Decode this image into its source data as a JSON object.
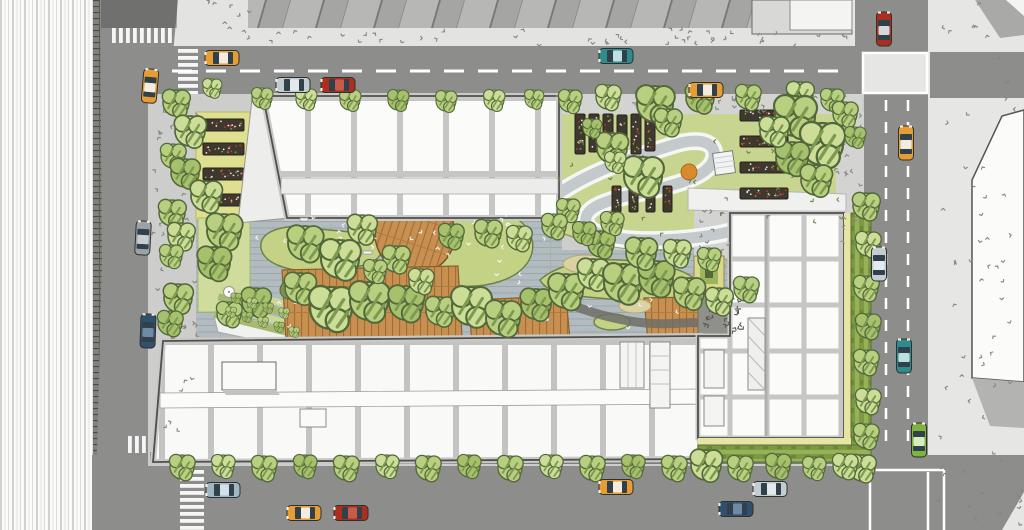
{
  "meta": {
    "title": "Aerial site plan illustration - urban block with landscaped green courtyard",
    "description": "Top-down architectural rendering: three white flat-roofed buildings around a central courtyard garden with trees, wood decks, lawns, an S-shaped path, raised planting beds, surrounded by streets with cars, crosswalks and sidewalks."
  },
  "palette": {
    "road": "#8d8d8b",
    "road_shadow": "#767674",
    "lane_white": "#ffffff",
    "sidewalk_site": "#cdcdcb",
    "sidewalk_far": "#e6e6e4",
    "sidewalk_light": "#e3e3e1",
    "building_white": "#fbfbf9",
    "mullion_gray": "#c6c6c4",
    "outline": "#4f4f4d",
    "deck_gray": "#b2bcc0",
    "wood": "#c79050",
    "lawn": "#c3d285",
    "lawn_light": "#cfdc9b",
    "garden": "#c8d590",
    "yellow_band": "#dfdf90",
    "planter_dark": "#3e382e",
    "hedge": "#7d9a43",
    "tree": "#b9cf80",
    "tree_light": "#cbdd96",
    "tree_dark": "#a6c06c",
    "sand": "#dbd2a3",
    "gravel": "#90908a",
    "path_gray": "#c4cacc",
    "car_red": "#ab2f1f",
    "car_teal": "#2f8c8c",
    "car_taxi": "#e79d33",
    "car_silver": "#c2cdd1",
    "car_navy": "#31506b",
    "car_green": "#7eb33d",
    "car_gray": "#9aa2a5"
  },
  "scene": {
    "trees": [
      [
        176,
        103,
        13,
        0
      ],
      [
        190,
        131,
        15,
        1
      ],
      [
        173,
        156,
        12,
        0
      ],
      [
        185,
        173,
        14,
        2
      ],
      [
        172,
        213,
        13,
        0
      ],
      [
        181,
        236,
        13,
        1
      ],
      [
        171,
        256,
        11,
        0
      ],
      [
        178,
        298,
        14,
        0
      ],
      [
        170,
        323,
        12,
        2
      ],
      [
        206,
        196,
        15,
        1
      ],
      [
        224,
        231,
        17,
        0
      ],
      [
        214,
        263,
        16,
        2
      ],
      [
        212,
        88,
        9,
        1
      ],
      [
        262,
        98,
        10,
        0
      ],
      [
        306,
        99,
        10,
        1
      ],
      [
        350,
        100,
        10,
        0
      ],
      [
        398,
        100,
        10,
        2
      ],
      [
        446,
        101,
        10,
        0
      ],
      [
        494,
        100,
        10,
        1
      ],
      [
        534,
        99,
        9,
        0
      ],
      [
        570,
        101,
        11,
        0
      ],
      [
        608,
        97,
        12,
        1
      ],
      [
        655,
        104,
        18,
        0
      ],
      [
        700,
        98,
        14,
        2
      ],
      [
        748,
        97,
        12,
        0
      ],
      [
        800,
        95,
        13,
        1
      ],
      [
        832,
        100,
        11,
        0
      ],
      [
        612,
        148,
        15,
        0
      ],
      [
        643,
        176,
        19,
        1
      ],
      [
        668,
        122,
        13,
        0
      ],
      [
        592,
        128,
        9,
        2
      ],
      [
        568,
        210,
        11,
        0
      ],
      [
        615,
        162,
        10,
        1
      ],
      [
        795,
        116,
        20,
        0
      ],
      [
        822,
        144,
        21,
        1
      ],
      [
        792,
        158,
        16,
        2
      ],
      [
        816,
        180,
        15,
        0
      ],
      [
        774,
        131,
        14,
        1
      ],
      [
        845,
        114,
        12,
        0
      ],
      [
        855,
        137,
        10,
        2
      ],
      [
        305,
        243,
        17,
        0
      ],
      [
        340,
        259,
        19,
        1
      ],
      [
        300,
        288,
        15,
        0
      ],
      [
        256,
        302,
        14,
        2
      ],
      [
        229,
        314,
        12,
        0
      ],
      [
        331,
        308,
        21,
        1
      ],
      [
        369,
        301,
        19,
        0
      ],
      [
        406,
        303,
        17,
        2
      ],
      [
        440,
        311,
        14,
        0
      ],
      [
        471,
        306,
        19,
        1
      ],
      [
        503,
        318,
        17,
        0
      ],
      [
        536,
        304,
        15,
        2
      ],
      [
        566,
        291,
        17,
        0
      ],
      [
        593,
        274,
        15,
        1
      ],
      [
        623,
        283,
        19,
        0
      ],
      [
        656,
        278,
        17,
        2
      ],
      [
        689,
        293,
        15,
        0
      ],
      [
        719,
        301,
        13,
        1
      ],
      [
        746,
        289,
        12,
        0
      ],
      [
        601,
        244,
        13,
        2
      ],
      [
        641,
        253,
        15,
        0
      ],
      [
        677,
        253,
        13,
        1
      ],
      [
        709,
        259,
        11,
        0
      ],
      [
        362,
        229,
        14,
        1
      ],
      [
        396,
        259,
        13,
        0
      ],
      [
        451,
        236,
        12,
        2
      ],
      [
        488,
        233,
        13,
        0
      ],
      [
        519,
        238,
        12,
        1
      ],
      [
        554,
        226,
        12,
        0
      ],
      [
        584,
        233,
        11,
        2
      ],
      [
        612,
        223,
        11,
        0
      ],
      [
        421,
        281,
        12,
        1
      ],
      [
        375,
        271,
        11,
        0
      ],
      [
        866,
        206,
        13,
        0
      ],
      [
        868,
        244,
        12,
        1
      ],
      [
        866,
        288,
        12,
        0
      ],
      [
        868,
        326,
        12,
        2
      ],
      [
        866,
        362,
        12,
        0
      ],
      [
        868,
        401,
        12,
        1
      ],
      [
        866,
        436,
        12,
        0
      ],
      [
        862,
        468,
        13,
        1
      ],
      [
        182,
        467,
        12,
        0
      ],
      [
        223,
        466,
        11,
        1
      ],
      [
        264,
        468,
        12,
        0
      ],
      [
        305,
        466,
        11,
        2
      ],
      [
        346,
        468,
        12,
        0
      ],
      [
        387,
        466,
        11,
        1
      ],
      [
        428,
        468,
        12,
        0
      ],
      [
        469,
        466,
        11,
        2
      ],
      [
        510,
        468,
        12,
        0
      ],
      [
        551,
        466,
        11,
        1
      ],
      [
        592,
        468,
        12,
        0
      ],
      [
        633,
        466,
        11,
        2
      ],
      [
        674,
        468,
        12,
        0
      ],
      [
        706,
        465,
        15,
        1
      ],
      [
        740,
        468,
        12,
        0
      ],
      [
        778,
        466,
        12,
        2
      ],
      [
        814,
        468,
        11,
        0
      ],
      [
        845,
        466,
        12,
        1
      ],
      [
        236,
        298,
        5,
        2
      ],
      [
        252,
        303,
        5,
        0
      ],
      [
        268,
        308,
        5,
        2
      ],
      [
        284,
        313,
        5,
        0
      ],
      [
        231,
        312,
        5,
        0
      ],
      [
        247,
        317,
        5,
        2
      ],
      [
        263,
        322,
        5,
        0
      ],
      [
        279,
        327,
        5,
        2
      ],
      [
        294,
        332,
        5,
        0
      ]
    ],
    "cars": [
      {
        "x": 222,
        "y": 58,
        "rot": 0,
        "body": "#e79d33",
        "roof": "#f2ede0"
      },
      {
        "x": 293,
        "y": 85,
        "rot": 0,
        "body": "#c2cdd1",
        "roof": "#e4eaec"
      },
      {
        "x": 338,
        "y": 85,
        "rot": 0,
        "body": "#ab2f1f",
        "roof": "#c65b4a"
      },
      {
        "x": 616,
        "y": 56,
        "rot": 0,
        "body": "#2f8c8c",
        "roof": "#bfe0e0"
      },
      {
        "x": 706,
        "y": 90,
        "rot": 0,
        "body": "#e79d33",
        "roof": "#f2ede0"
      },
      {
        "x": 884,
        "y": 29,
        "rot": 90,
        "body": "#ab2f1f",
        "roof": "#d5d8d8"
      },
      {
        "x": 906,
        "y": 143,
        "rot": 90,
        "body": "#e79d33",
        "roof": "#f2ede0"
      },
      {
        "x": 879,
        "y": 264,
        "rot": 90,
        "body": "#c2cdd1",
        "roof": "#e4eaec"
      },
      {
        "x": 904,
        "y": 356,
        "rot": 90,
        "body": "#2f8c8c",
        "roof": "#bfe0e0"
      },
      {
        "x": 919,
        "y": 440,
        "rot": 90,
        "body": "#7eb33d",
        "roof": "#d9ecc0"
      },
      {
        "x": 150,
        "y": 86,
        "rot": 95,
        "body": "#e79d33",
        "roof": "#f2ede0"
      },
      {
        "x": 143,
        "y": 238,
        "rot": 93,
        "body": "#9aa2a5",
        "roof": "#c8cfd2"
      },
      {
        "x": 148,
        "y": 331,
        "rot": 92,
        "body": "#31506b",
        "roof": "#6e8aa5"
      },
      {
        "x": 223,
        "y": 490,
        "rot": 0,
        "body": "#9fb6c4",
        "roof": "#d3e2ea"
      },
      {
        "x": 304,
        "y": 513,
        "rot": 0,
        "body": "#e79d33",
        "roof": "#f2ede0"
      },
      {
        "x": 351,
        "y": 513,
        "rot": 0,
        "body": "#ab2f1f",
        "roof": "#c65b4a"
      },
      {
        "x": 616,
        "y": 487,
        "rot": 0,
        "body": "#e79d33",
        "roof": "#f2ede0"
      },
      {
        "x": 770,
        "y": 489,
        "rot": 0,
        "body": "#c2cdd1",
        "roof": "#e4eaec"
      },
      {
        "x": 736,
        "y": 509,
        "rot": 0,
        "body": "#31506b",
        "roof": "#6e8aa5"
      }
    ],
    "garden_beds": [
      [
        575,
        114,
        10,
        40
      ],
      [
        589,
        114,
        10,
        38
      ],
      [
        603,
        114,
        10,
        40
      ],
      [
        617,
        115,
        10,
        38
      ],
      [
        631,
        114,
        10,
        40
      ],
      [
        645,
        115,
        10,
        36
      ],
      [
        612,
        186,
        9,
        26
      ],
      [
        629,
        186,
        9,
        26
      ],
      [
        646,
        187,
        9,
        25
      ],
      [
        663,
        186,
        9,
        26
      ],
      [
        740,
        110,
        48,
        11
      ],
      [
        740,
        136,
        48,
        11
      ],
      [
        740,
        162,
        48,
        11
      ],
      [
        740,
        188,
        48,
        11
      ]
    ],
    "left_planters": [
      [
        203,
        119,
        41,
        12
      ],
      [
        203,
        143,
        41,
        12
      ],
      [
        203,
        168,
        41,
        12
      ],
      [
        203,
        194,
        41,
        12
      ]
    ],
    "crosswalks": [
      {
        "x": 112,
        "y": 28,
        "w": 62,
        "h": 15,
        "dir": "h"
      },
      {
        "x": 178,
        "y": 49,
        "w": 20,
        "h": 45,
        "dir": "v"
      },
      {
        "x": 180,
        "y": 470,
        "w": 24,
        "h": 58,
        "dir": "v"
      },
      {
        "x": 128,
        "y": 436,
        "w": 24,
        "h": 17,
        "dir": "h"
      }
    ],
    "stipples": [
      {
        "x": 155,
        "y": 98,
        "w": 44,
        "h": 340,
        "n": 42,
        "c": "#85857f"
      },
      {
        "x": 208,
        "y": 2,
        "w": 40,
        "h": 42,
        "n": 10,
        "c": "#85857f"
      },
      {
        "x": 255,
        "y": 30,
        "w": 500,
        "h": 15,
        "n": 36,
        "c": "#85857f"
      },
      {
        "x": 760,
        "y": 32,
        "w": 88,
        "h": 12,
        "n": 8,
        "c": "#85857f"
      },
      {
        "x": 935,
        "y": 2,
        "w": 82,
        "h": 520,
        "n": 55,
        "c": "#85857f"
      },
      {
        "x": 554,
        "y": 96,
        "w": 300,
        "h": 15,
        "n": 26,
        "c": "#85857f"
      },
      {
        "x": 838,
        "y": 114,
        "w": 24,
        "h": 140,
        "n": 22,
        "c": "#85857f"
      },
      {
        "x": 696,
        "y": 194,
        "w": 32,
        "h": 60,
        "n": 12,
        "c": "#85857f"
      },
      {
        "x": 205,
        "y": 214,
        "w": 480,
        "h": 118,
        "n": 46,
        "c": "#f2f4f2"
      },
      {
        "x": 560,
        "y": 118,
        "w": 260,
        "h": 120,
        "n": 22,
        "c": "#6e7f49"
      },
      {
        "x": 700,
        "y": 294,
        "w": 42,
        "h": 40,
        "n": 26,
        "c": "#55554f"
      },
      {
        "x": 300,
        "y": 230,
        "w": 80,
        "h": 36,
        "n": 9,
        "c": "#fafaf8"
      },
      {
        "x": 430,
        "y": 215,
        "w": 90,
        "h": 60,
        "n": 10,
        "c": "#fafaf8"
      },
      {
        "x": 1000,
        "y": 492,
        "w": 22,
        "h": 34,
        "n": 5,
        "c": "#85857f"
      }
    ],
    "benches": [
      [
        363,
        251,
        9,
        3
      ],
      [
        488,
        231,
        3,
        13
      ],
      [
        540,
        318,
        9,
        3
      ],
      [
        300,
        218,
        8,
        3
      ]
    ],
    "tables": [
      [
        222,
        240
      ],
      [
        229,
        292
      ]
    ]
  }
}
